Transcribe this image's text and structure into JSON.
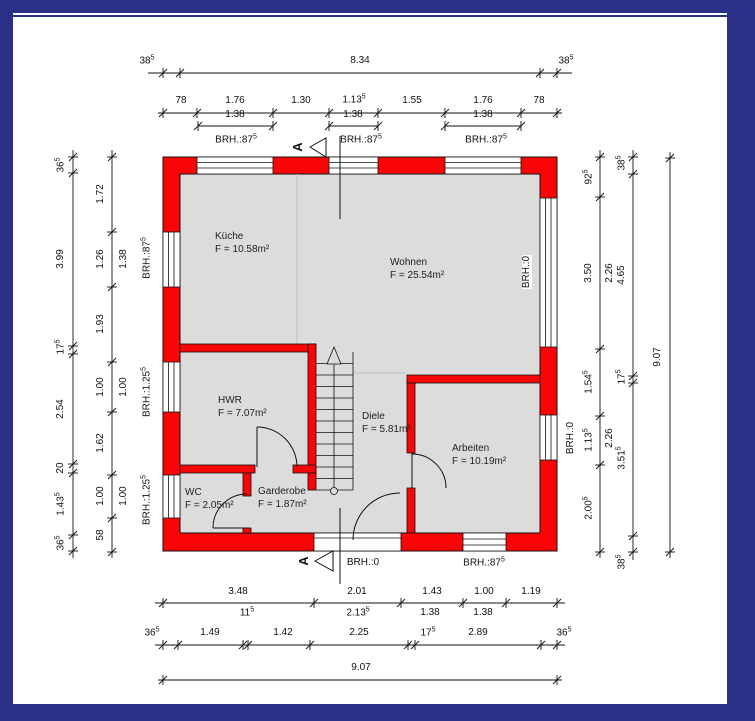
{
  "drawing": {
    "colors": {
      "wall_red": "#fa0505",
      "floor_gray": "#dcdcdc",
      "frame_navy": "#2b3087",
      "line": "#111111",
      "faint": "#bfbfbf"
    },
    "section_marker": {
      "label": "A"
    },
    "rooms": {
      "kueche": {
        "name": "Küche",
        "area": "F = 10.58m²"
      },
      "wohnen": {
        "name": "Wohnen",
        "area": "F = 25.54m²"
      },
      "hwr": {
        "name": "HWR",
        "area": "F = 7.07m²"
      },
      "diele": {
        "name": "Diele",
        "area": "F = 5.81m²"
      },
      "arbeiten": {
        "name": "Arbeiten",
        "area": "F = 10.19m²"
      },
      "wc": {
        "name": "WC",
        "area": "F = 2.05m²"
      },
      "garderobe": {
        "name": "Garderobe",
        "area": "F = 1.87m²"
      }
    },
    "dimensions": {
      "top": {
        "row0": [
          "38^5",
          "8.34",
          "38^5"
        ],
        "row1": [
          "78",
          "1.76",
          "1.30",
          "1.13^5",
          "1.55",
          "1.76",
          "78"
        ],
        "glass": [
          "1.38",
          "1.38",
          "1.38"
        ],
        "brh": [
          "BRH.:87^5",
          "BRH.:87^5",
          "BRH.:87^5"
        ]
      },
      "left": {
        "outer": [
          "36^5",
          "3.99",
          "17^5",
          "2.54",
          "20",
          "1.43^5",
          "36^5"
        ],
        "inner": [
          "1.72",
          "1.26",
          "1.93",
          "1.00",
          "1.62",
          "1.00",
          "58"
        ],
        "glass": [
          "1.38",
          "1.00",
          "1.00"
        ],
        "brh": [
          "BRH.:87^5",
          "BRH.:1.25^5",
          "BRH.:1.25^5"
        ]
      },
      "right": {
        "inner": [
          "92^5",
          "3.50",
          "1.54^5",
          "1.13^5",
          "2.00^5"
        ],
        "glass": [
          "2.26",
          "2.26"
        ],
        "mid": [
          "38^5",
          "4.65",
          "17^5",
          "3.51^5",
          "38^5"
        ],
        "total": "9.07",
        "brh": [
          "BRH.:0",
          "BRH.:0"
        ]
      },
      "bottom": {
        "row1": [
          "3.48",
          "2.01",
          "1.43",
          "1.00",
          "1.19"
        ],
        "sub": [
          "11^5",
          "2.13^5",
          "1.38",
          "1.38"
        ],
        "row2": [
          "36^5",
          "1.49",
          "1.42",
          "2.25",
          "17^5",
          "2.89",
          "36^5"
        ],
        "total": "9.07",
        "brh": [
          "BRH.:0",
          "BRH.:87^5"
        ]
      }
    }
  }
}
